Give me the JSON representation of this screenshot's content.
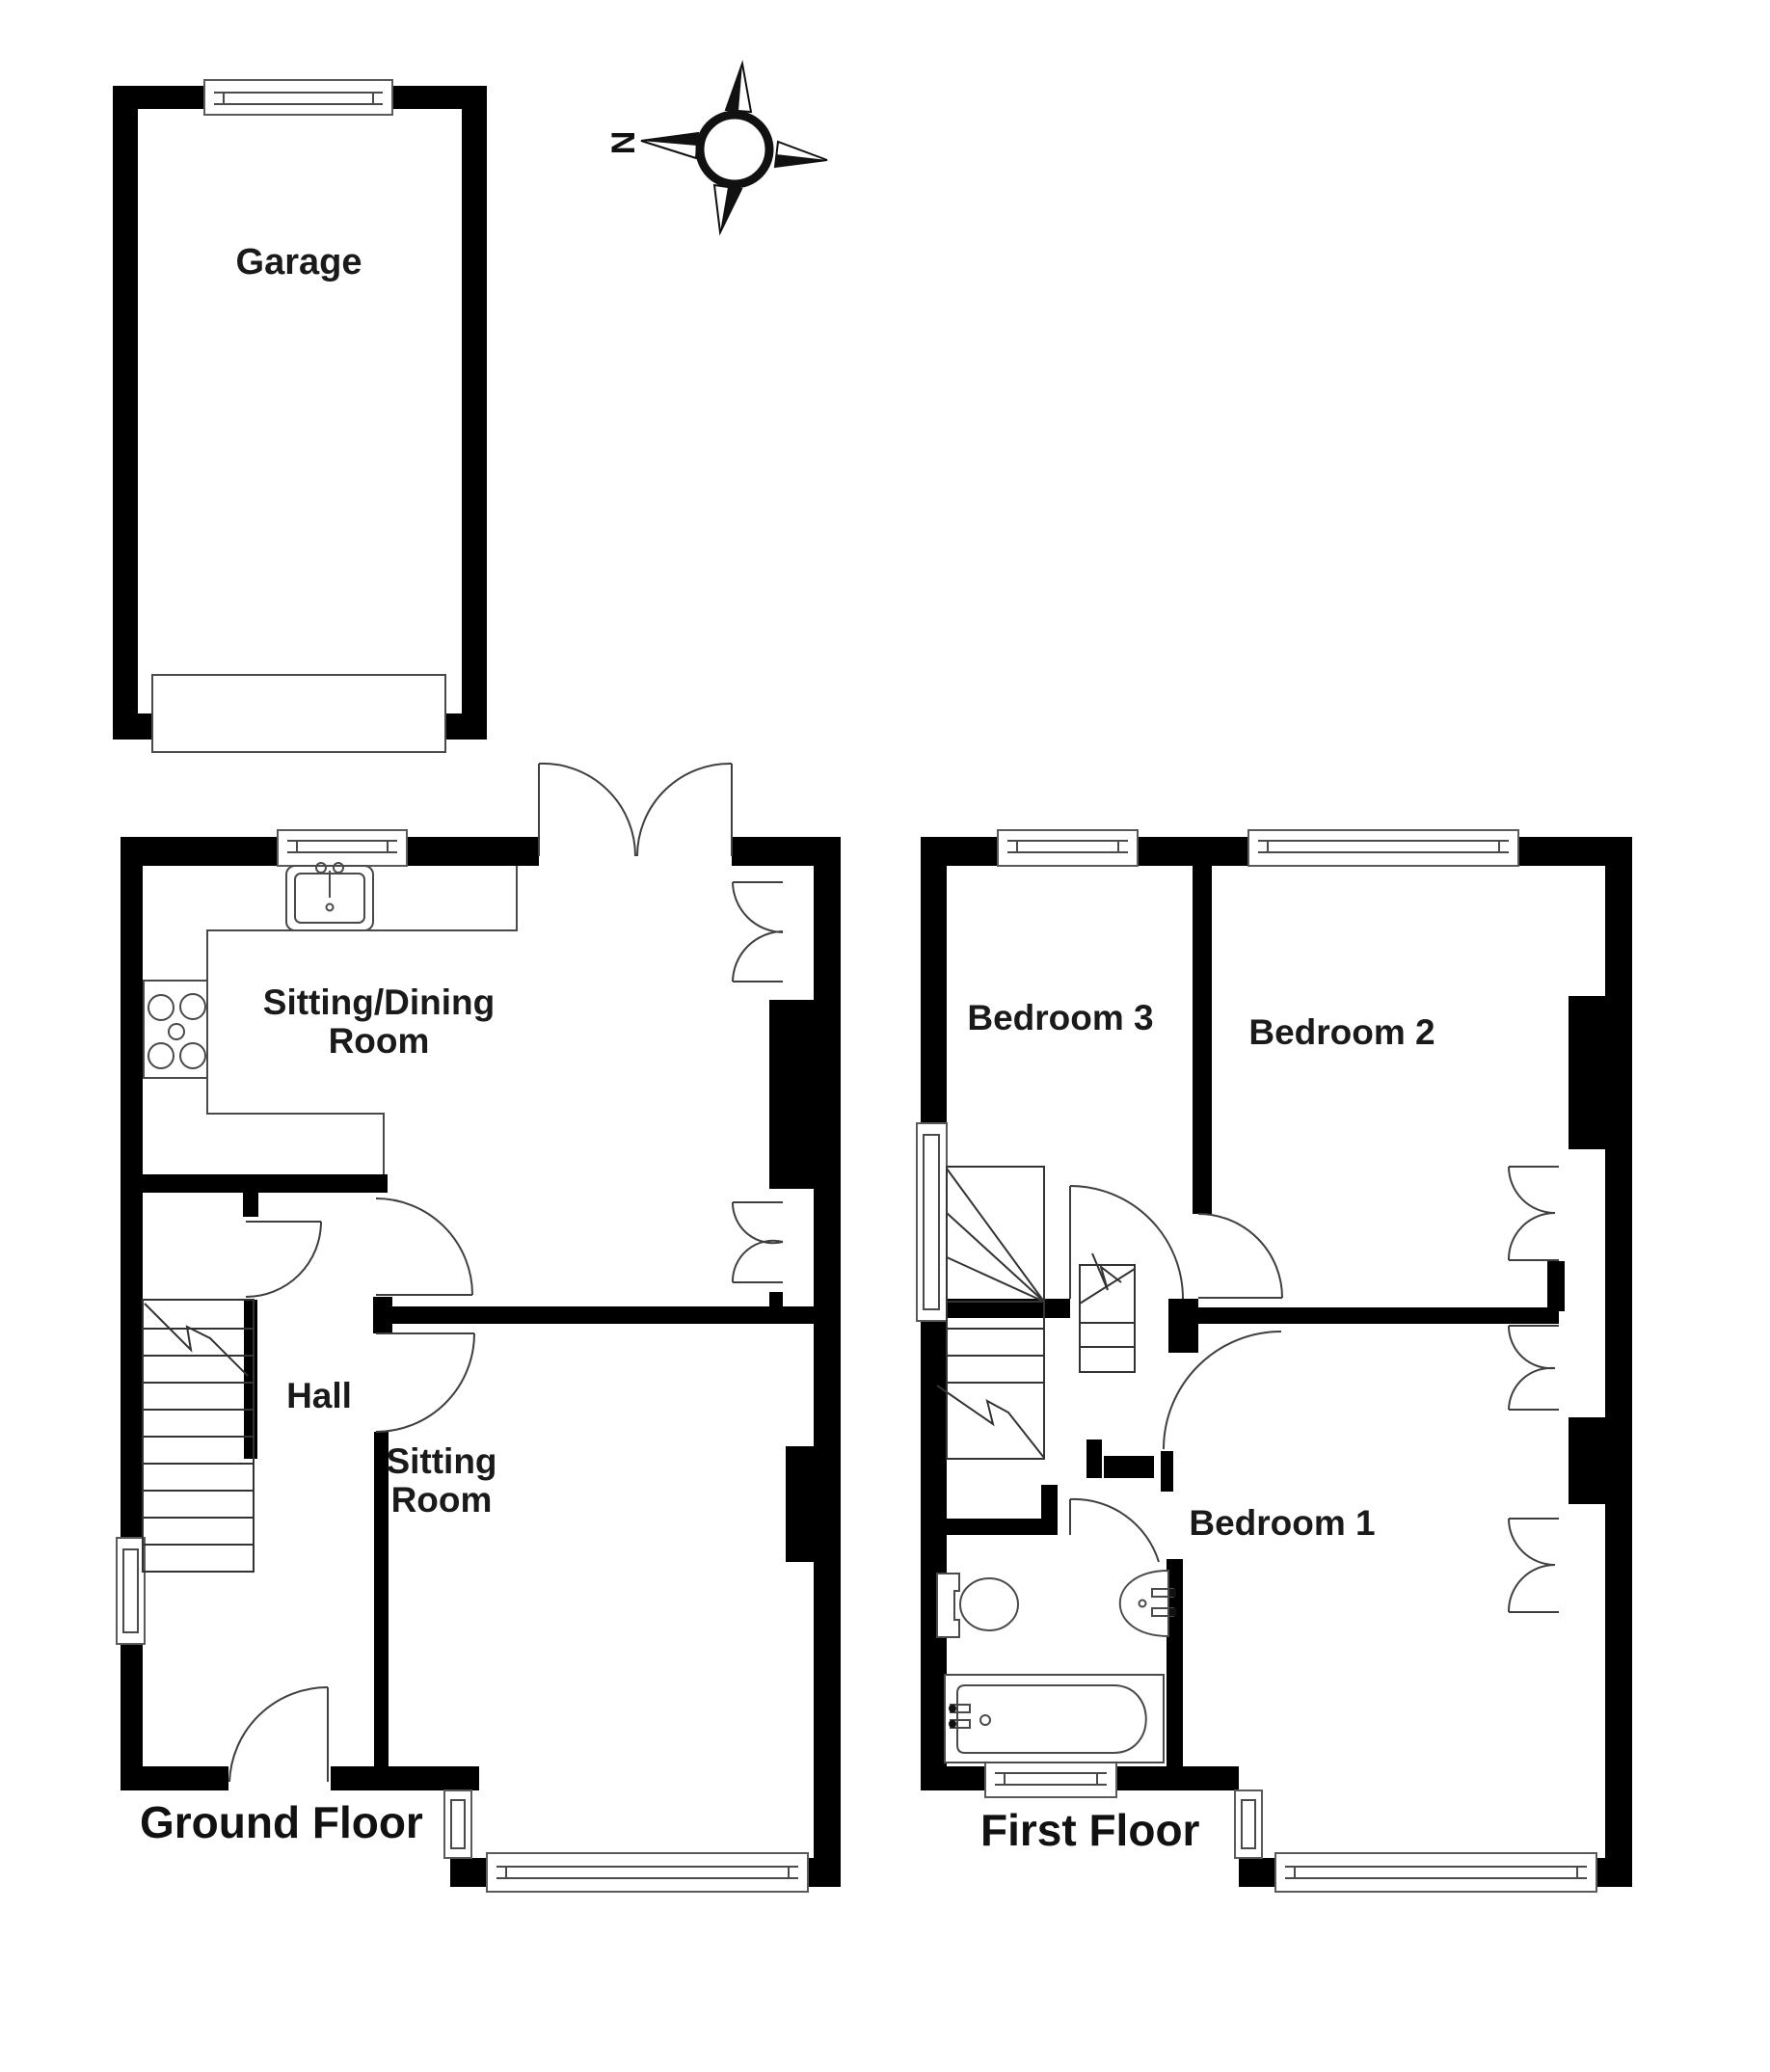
{
  "title": "House floor plan",
  "compass": {
    "north_label": "N"
  },
  "garage": {
    "label": "Garage"
  },
  "ground_floor": {
    "floor_label": "Ground Floor",
    "rooms": {
      "sitting_dining_line1": "Sitting/Dining",
      "sitting_dining_line2": "Room",
      "hall": "Hall",
      "sitting_line1": "Sitting",
      "sitting_line2": "Room"
    }
  },
  "first_floor": {
    "floor_label": "First Floor",
    "rooms": {
      "bedroom3": "Bedroom 3",
      "bedroom2": "Bedroom 2",
      "bedroom1": "Bedroom 1"
    }
  },
  "colors": {
    "wall": "#000000",
    "background": "#ffffff",
    "fixture_line": "#4a4a4a",
    "text": "#1a1a1a"
  }
}
